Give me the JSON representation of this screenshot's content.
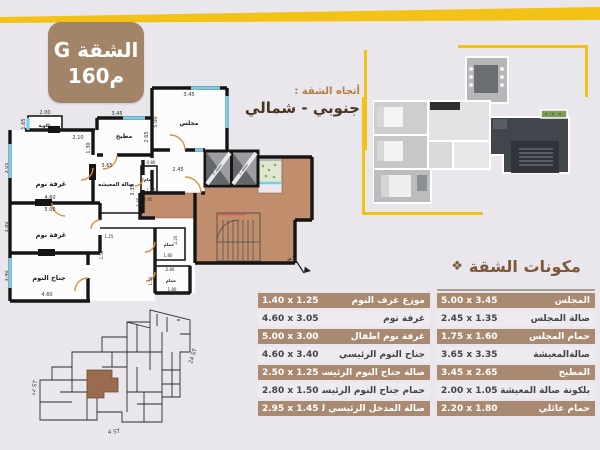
{
  "badge": {
    "title": "الشقة G",
    "area": "160م"
  },
  "direction": {
    "label": "أتجاه الشقة :",
    "value": "جنوبي - شمالي"
  },
  "components": {
    "icon": "❖",
    "heading": "مكونات الشقة"
  },
  "tables": {
    "left": {
      "rows": [
        {
          "name": "موزع غرف النوم",
          "dims": "1.40 x 1.25"
        },
        {
          "name": "غرفة نوم",
          "dims": "4.60 x 3.05"
        },
        {
          "name": "غرفة نوم أطفال",
          "dims": "5.00 x 3.00"
        },
        {
          "name": "جناح النوم الرئيسي",
          "dims": "4.60 x 3.40"
        },
        {
          "name": "صالة جناح النوم الرئيسي",
          "dims": "2.50 x 1.25"
        },
        {
          "name": "حمام جناح النوم الرئيسي",
          "dims": "2.80 x 1.50"
        },
        {
          "name": "صالة المدخل الرئيسي للشقة",
          "dims": "2.95 x 1.45"
        }
      ]
    },
    "right": {
      "rows": [
        {
          "name": "المجلس",
          "dims": "5.00 x 3.45"
        },
        {
          "name": "صالة المجلس",
          "dims": "2.45 x 1.35"
        },
        {
          "name": "حمام المجلس",
          "dims": "1.75 x 1.60"
        },
        {
          "name": "صالةالمعيشة",
          "dims": "3.65 x 3.35"
        },
        {
          "name": "المطبخ",
          "dims": "3.45 x 2.65"
        },
        {
          "name": "بلكونة صالة المعيشة",
          "dims": "2.00 x 1.05"
        },
        {
          "name": "حمام عائلي",
          "dims": "2.20 x 1.80"
        }
      ]
    }
  },
  "floorplan": {
    "labels": {
      "balcony": "بلكونة",
      "bedroom1": "غرفة نوم",
      "bedroom2": "غرفة نوم",
      "master_suite": "جناح النوم",
      "kitchen": "مطبخ",
      "majlis": "مجلس",
      "living": "صالة المعيشه",
      "bath1": "حمام",
      "bath2": "حمام",
      "bath3": "حمام",
      "elevator1": "مصعد 1",
      "elevator2": "مصعد 2",
      "north": "N"
    },
    "dims": [
      "2.00",
      "1.65",
      "2.10",
      "1.30",
      "3.45",
      "2.65",
      "3.45",
      "5.00",
      "3.05",
      "4.60",
      "5.00",
      "3.80",
      "3.40",
      "4.60",
      "3.65",
      "3.35",
      "0.80",
      "1.60",
      "2.95",
      "1.45",
      "2.45",
      "1.25",
      "2.50",
      "2.20",
      "1.80",
      "2.80",
      "1.50",
      "1.80"
    ]
  },
  "siteplan": {
    "street_left": "12 ST",
    "street_right": "24 ST",
    "street_bottom": "4 ST"
  },
  "colors": {
    "accent_yellow": "#f3c217",
    "badge_brown": "#a28468",
    "row_brown": "#a98a70",
    "lobby_tan": "#c08e6d"
  }
}
